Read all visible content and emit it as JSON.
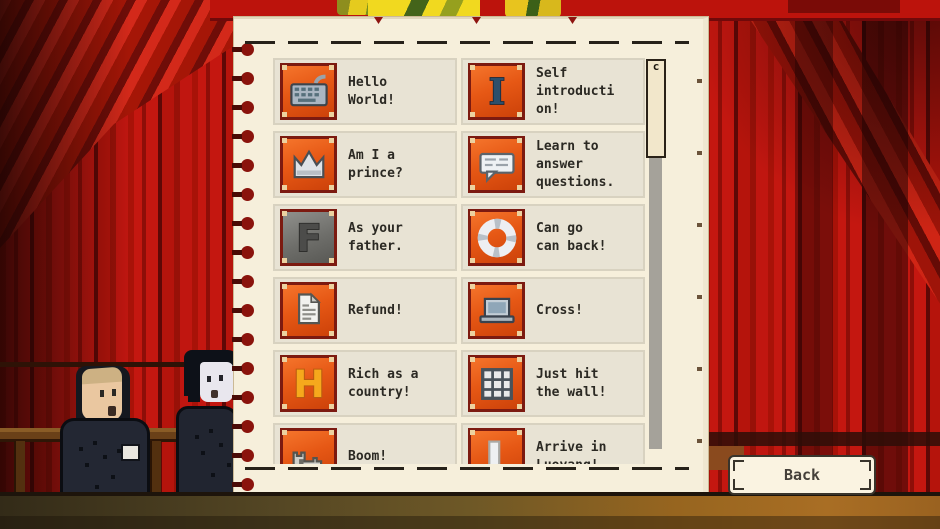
{
  "achievements": {
    "items": [
      {
        "title": "Hello\nWorld!",
        "icon": "keyboard"
      },
      {
        "title": "Self\nintroducti\non!",
        "icon": "letter-I",
        "letter": "I"
      },
      {
        "title": "Am I a\nprince?",
        "icon": "crown"
      },
      {
        "title": "Learn to\nanswer\nquestions.",
        "icon": "speech-bubble"
      },
      {
        "title": "As your\nfather.",
        "icon": "letter-F",
        "letter": "F"
      },
      {
        "title": "Can go\ncan back!",
        "icon": "ring"
      },
      {
        "title": "Refund!",
        "icon": "document"
      },
      {
        "title": "Cross!",
        "icon": "laptop"
      },
      {
        "title": "Rich as a\ncountry!",
        "icon": "letter-H",
        "letter": "H"
      },
      {
        "title": "Just hit\nthe wall!",
        "icon": "brick-grid"
      },
      {
        "title": "Boom!",
        "icon": "castle"
      },
      {
        "title": "Arrive in\nLuoyang!",
        "icon": "door-bar"
      }
    ],
    "scrollbar_glyph": "c"
  },
  "buttons": {
    "back": "Back"
  },
  "colors": {
    "curtain_red": "#b51510",
    "page_cream": "#f6efdb",
    "row_bg": "#e8e3d4",
    "tile_orange": "#e65815",
    "tile_border": "#7c1a10",
    "floor_brown": "#6e5826",
    "button_cream": "#faf3e1"
  }
}
